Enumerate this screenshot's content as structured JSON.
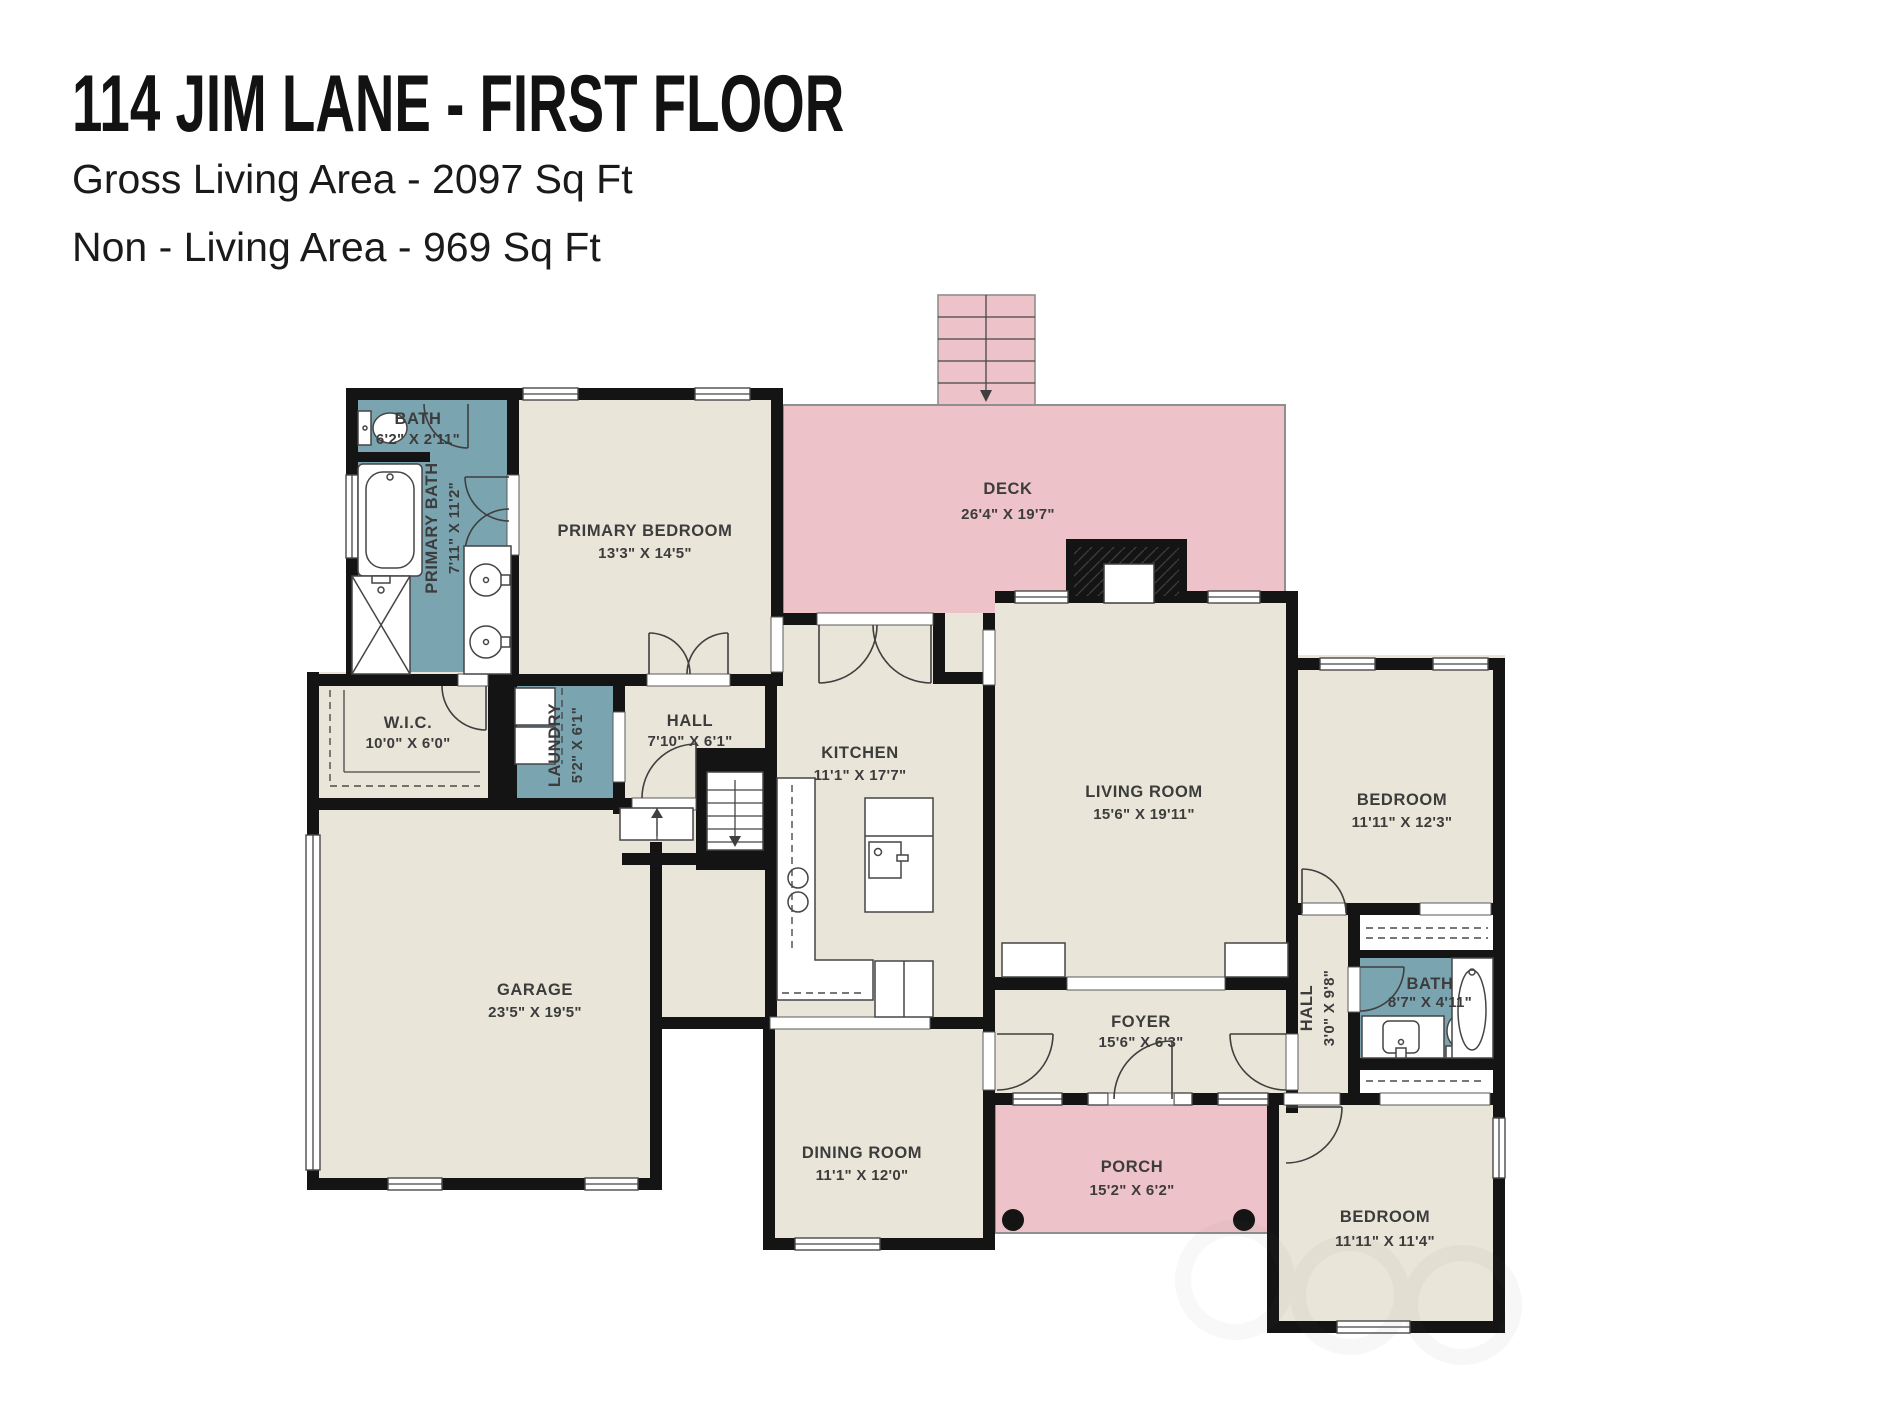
{
  "header": {
    "title": "114 JIM LANE - FIRST FLOOR",
    "subtitle1": "Gross Living Area - 2097 Sq Ft",
    "subtitle2": "Non - Living Area - 969 Sq Ft"
  },
  "colors": {
    "floor": "#e9e6d9",
    "wet_room": "#7aa5b0",
    "outdoor": "#edc3c9",
    "wall": "#141414"
  },
  "rooms": {
    "deck": {
      "name": "DECK",
      "dims": "26'4\" X 19'7\""
    },
    "bath_top": {
      "name": "BATH",
      "dims": "6'2\" X 2'11\""
    },
    "primary_bath": {
      "name": "PRIMARY BATH",
      "dims": "7'11\" X 11'2\""
    },
    "primary_bedroom": {
      "name": "PRIMARY BEDROOM",
      "dims": "13'3\" X 14'5\""
    },
    "wic": {
      "name": "W.I.C.",
      "dims": "10'0\" X 6'0\""
    },
    "laundry": {
      "name": "LAUNDRY",
      "dims": "5'2\" X 6'1\""
    },
    "hall_center": {
      "name": "HALL",
      "dims": "7'10\" X 6'1\""
    },
    "kitchen": {
      "name": "KITCHEN",
      "dims": "11'1\" X 17'7\""
    },
    "living_room": {
      "name": "LIVING ROOM",
      "dims": "15'6\" X 19'11\""
    },
    "bedroom_right": {
      "name": "BEDROOM",
      "dims": "11'11\" X 12'3\""
    },
    "garage": {
      "name": "GARAGE",
      "dims": "23'5\" X 19'5\""
    },
    "foyer": {
      "name": "FOYER",
      "dims": "15'6\" X 6'3\""
    },
    "hall_right": {
      "name": "HALL",
      "dims": "3'0\" X 9'8\""
    },
    "bath_right": {
      "name": "BATH",
      "dims": "8'7\" X 4'11\""
    },
    "dining_room": {
      "name": "DINING ROOM",
      "dims": "11'1\" X 12'0\""
    },
    "porch": {
      "name": "PORCH",
      "dims": "15'2\" X 6'2\""
    },
    "bedroom_bottom": {
      "name": "BEDROOM",
      "dims": "11'11\" X 11'4\""
    }
  }
}
